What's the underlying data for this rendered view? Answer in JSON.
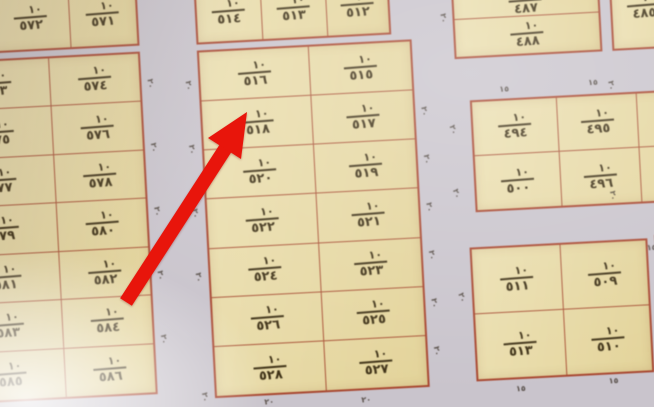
{
  "fraction_numerator": "١٠",
  "arrow": {
    "color": "#e8150b",
    "target_plot": "٥١٨"
  },
  "colors": {
    "plot_fill": "#e8dba8",
    "grid_line": "#a84730",
    "paper_street": "#c9c4cc",
    "ink": "#3d3015",
    "arrow_red": "#e8150b"
  },
  "blocks": {
    "top_left": {
      "cells": [
        "٥٧٢",
        "٥٧١"
      ]
    },
    "left": {
      "rows": [
        [
          "٥٧٣",
          "٥٧٤"
        ],
        [
          "٥٧٥",
          "٥٧٦"
        ],
        [
          "٥٧٧",
          "٥٧٨"
        ],
        [
          "٥٧٩",
          "٥٨٠"
        ],
        [
          "٥٨١",
          "٥٨٢"
        ],
        [
          "٥٨٣",
          "٥٨٤"
        ],
        [
          "٥٨٥",
          "٥٨٦"
        ]
      ]
    },
    "middle_top": {
      "cells": [
        "٥١٤",
        "٥١٣",
        "٥١٢"
      ]
    },
    "middle": {
      "rows": [
        [
          "٥١٦",
          "٥١٥"
        ],
        [
          "٥١٨",
          "٥١٧"
        ],
        [
          "٥٢٠",
          "٥١٩"
        ],
        [
          "٥٢٢",
          "٥٢١"
        ],
        [
          "٥٢٤",
          "٥٢٣"
        ],
        [
          "٥٢٦",
          "٥٢٥"
        ],
        [
          "٥٢٨",
          "٥٢٧"
        ]
      ]
    },
    "top_right": {
      "partial_upper": "٤٨٧",
      "cell": "٤٨٨"
    },
    "far_top_right": {
      "cell": "٤٨٥"
    },
    "right_middle": {
      "rows": [
        [
          "٤٩٤",
          "٤٩٥"
        ],
        [
          "٥٠٠",
          "٤٩٦"
        ]
      ]
    },
    "right_bottom": {
      "rows": [
        [
          "٥١١",
          "٥٠٩"
        ],
        [
          "٥١٣",
          "٥١٠"
        ]
      ]
    }
  },
  "dimension_labels": {
    "twenty": "٢٠",
    "fifteen": "١٥"
  }
}
